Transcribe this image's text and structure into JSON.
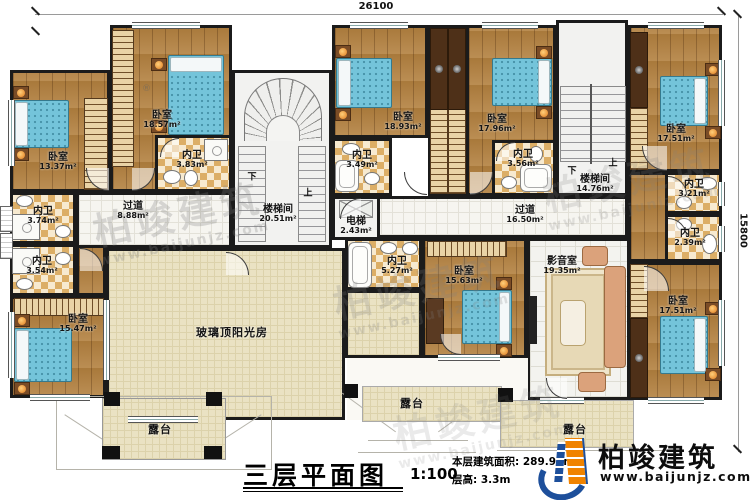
{
  "dims": {
    "width": "26100",
    "height": "15800"
  },
  "rooms": {
    "bed1337": {
      "name": "卧室",
      "area": "13.37m²"
    },
    "bed1857": {
      "name": "卧室",
      "area": "18.57m²"
    },
    "wc383": {
      "name": "内卫",
      "area": "3.83m²"
    },
    "wc374": {
      "name": "内卫",
      "area": "3.74m²"
    },
    "wc354": {
      "name": "内卫",
      "area": "3.54m²"
    },
    "bed1547": {
      "name": "卧室",
      "area": "15.47m²"
    },
    "hall888": {
      "name": "过道",
      "area": "8.88m²"
    },
    "stair2051": {
      "name": "楼梯间",
      "area": "20.51m²"
    },
    "lift243": {
      "name": "电梯",
      "area": "2.43m²"
    },
    "wc349": {
      "name": "内卫",
      "area": "3.49m²"
    },
    "bed1893": {
      "name": "卧室",
      "area": "18.93m²"
    },
    "bed1796": {
      "name": "卧室",
      "area": "17.96m²"
    },
    "wc356": {
      "name": "内卫",
      "area": "3.56m²"
    },
    "stair1476": {
      "name": "楼梯间",
      "area": "14.76m²"
    },
    "hall1650": {
      "name": "过道",
      "area": "16.50m²"
    },
    "bed1751a": {
      "name": "卧室",
      "area": "17.51m²"
    },
    "wc321": {
      "name": "内卫",
      "area": "3.21m²"
    },
    "wc239": {
      "name": "内卫",
      "area": "2.39m²"
    },
    "bed1751b": {
      "name": "卧室",
      "area": "17.51m²"
    },
    "av1935": {
      "name": "影音室",
      "area": "19.35m²"
    },
    "bed1563": {
      "name": "卧室",
      "area": "15.63m²"
    },
    "wc527": {
      "name": "内卫",
      "area": "5.27m²"
    },
    "sunroom": {
      "name": "玻璃顶阳光房"
    },
    "terraceL": {
      "name": "露台"
    },
    "terraceC": {
      "name": "露台"
    },
    "terraceR": {
      "name": "露台"
    }
  },
  "stairs": {
    "up": "上",
    "down": "下"
  },
  "titleblock": {
    "title": "三层平面图",
    "scale": "1:100",
    "area": "本层建筑面积: 289.97m²",
    "floor_height": "层高: 3.3m"
  },
  "brand": {
    "name": "柏竣建筑",
    "site": "www.baijunjz.com"
  },
  "watermark": {
    "name": "柏竣建筑",
    "site": "www.baijunjz.com",
    "reg": "®"
  }
}
